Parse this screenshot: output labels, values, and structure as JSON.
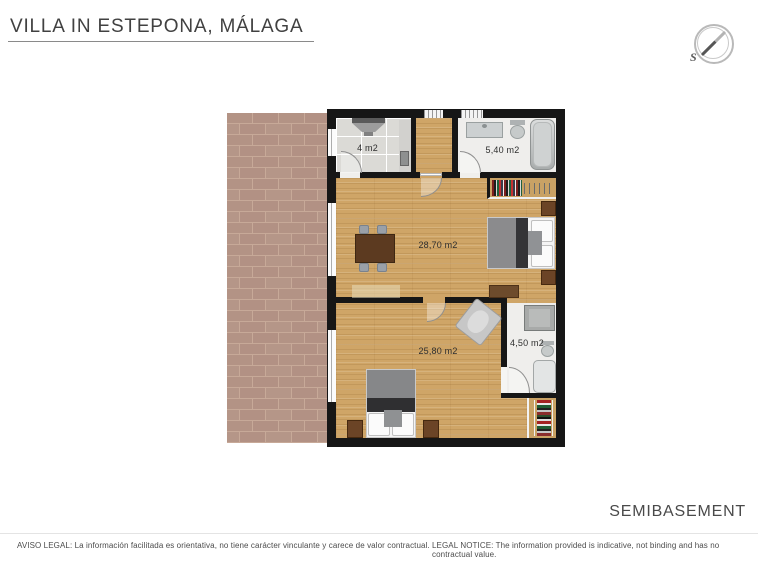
{
  "header": {
    "title": "VILLA IN ESTEPONA, MÁLAGA",
    "floor_label": "SEMIBASEMENT"
  },
  "compass": {
    "south_label": "S"
  },
  "rooms": [
    {
      "id": "kitchen",
      "area_label": "4 m2"
    },
    {
      "id": "bathroom-top",
      "area_label": "5,40 m2"
    },
    {
      "id": "living-bedroom",
      "area_label": "28,70 m2"
    },
    {
      "id": "bedroom",
      "area_label": "25,80 m2"
    },
    {
      "id": "bathroom-bottom",
      "area_label": "4,50 m2"
    }
  ],
  "footer": {
    "aviso_legal": "AVISO LEGAL: La información facilitada es orientativa, no tiene carácter vinculante y carece de valor contractual.",
    "legal_notice": "LEGAL NOTICE: The information provided is indicative, not binding and has no contractual value."
  },
  "colors": {
    "wall": "#161616",
    "wood_floor": "#cfa567",
    "terrace_brick": "#b39385",
    "terrace_grout": "#c7a998",
    "tile_floor": "#dbdad6",
    "bath_floor": "#efeeec"
  },
  "icons": {
    "compass": "compass-icon"
  }
}
